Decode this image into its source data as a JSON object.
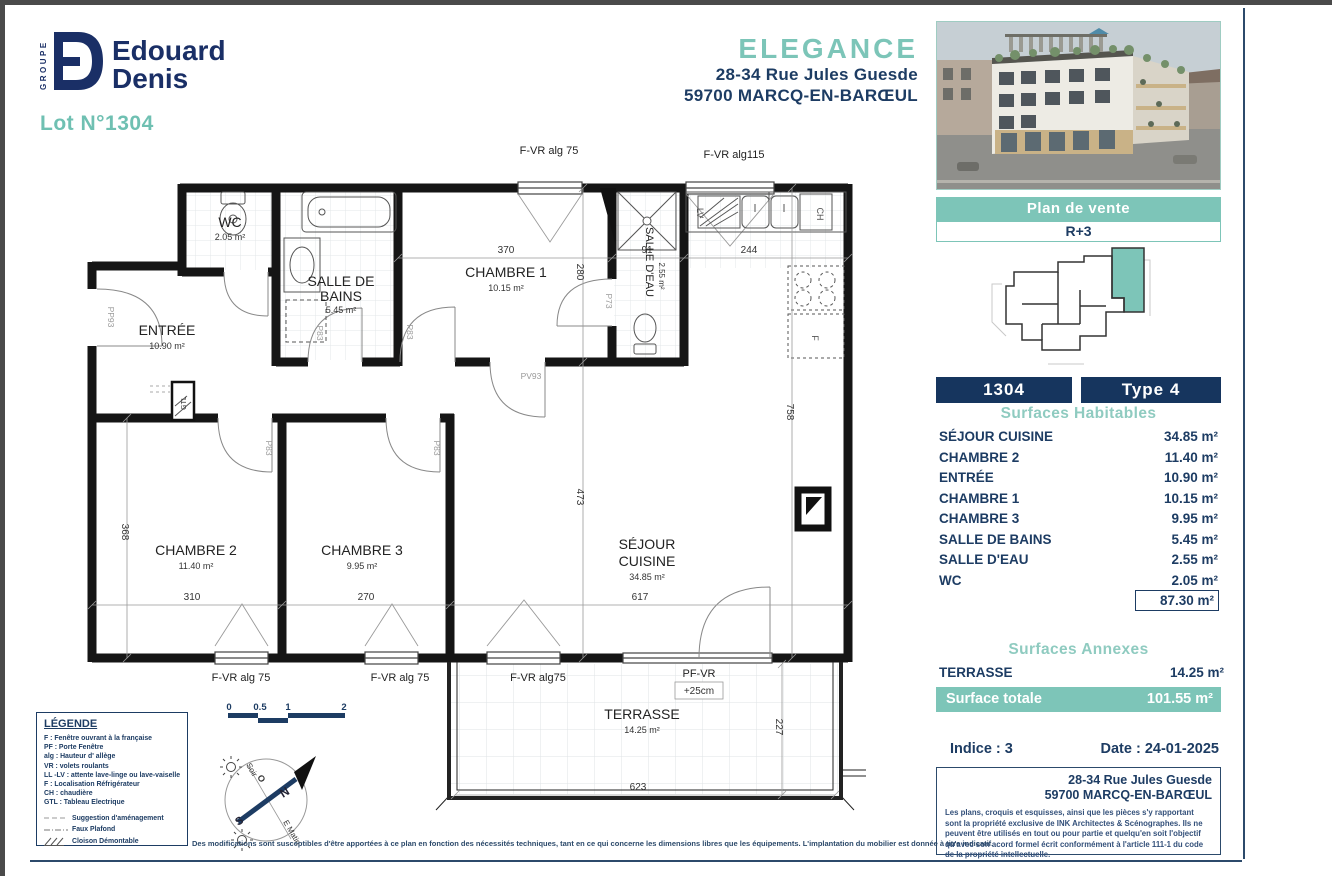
{
  "header": {
    "brand_group": "GROUPE",
    "brand_line1": "Edouard",
    "brand_line2": "Denis",
    "lot": "Lot N°1304",
    "project": "ELEGANCE",
    "address_line1": "28-34 Rue Jules Guesde",
    "address_line2": "59700 MARCQ-EN-BARŒUL"
  },
  "sidebar": {
    "plan_de_vente": "Plan de vente",
    "floor": "R+3",
    "lot_number": "1304",
    "type": "Type 4",
    "surfaces_habitables": {
      "title": "Surfaces Habitables",
      "rows": [
        {
          "label": "SÉJOUR CUISINE",
          "value": "34.85 m²"
        },
        {
          "label": "CHAMBRE 2",
          "value": "11.40 m²"
        },
        {
          "label": "ENTRÉE",
          "value": "10.90 m²"
        },
        {
          "label": "CHAMBRE 1",
          "value": "10.15 m²"
        },
        {
          "label": "CHAMBRE 3",
          "value": "9.95 m²"
        },
        {
          "label": "SALLE DE BAINS",
          "value": "5.45 m²"
        },
        {
          "label": "SALLE D'EAU",
          "value": "2.55 m²"
        },
        {
          "label": "WC",
          "value": "2.05 m²"
        }
      ],
      "total": "87.30 m²"
    },
    "surfaces_annexes": {
      "title": "Surfaces Annexes",
      "rows": [
        {
          "label": "TERRASSE",
          "value": "14.25 m²"
        }
      ]
    },
    "surface_totale": {
      "label": "Surface totale",
      "value": "101.55 m²"
    },
    "indice": "Indice : 3",
    "date": "Date : 24-01-2025",
    "footer_address1": "28-34 Rue Jules Guesde",
    "footer_address2": "59700 MARCQ-EN-BARŒUL",
    "copyright": "Les plans, croquis et esquisses, ainsi que les pièces s'y rapportant sont la propriété exclusive de INK Architectes & Scénographes. Ils ne peuvent être utilisés en tout ou pour partie et quelqu'en soit l'objectif qu'avec son acord formel écrit conformément à l'article 111-1 du code de la propriété intellectuelle."
  },
  "plan": {
    "rooms": [
      {
        "n1": "WC",
        "area": "2.05 m²"
      },
      {
        "n1": "SALLE DE",
        "n2": "BAINS",
        "area": "5.45 m²"
      },
      {
        "n1": "CHAMBRE 1",
        "area": "10.15 m²"
      },
      {
        "n1": "SALLE D'EAU",
        "area": "2.55 m²"
      },
      {
        "n1": "ENTRÉE",
        "area": "10.90 m²"
      },
      {
        "n1": "CHAMBRE 2",
        "area": "11.40 m²"
      },
      {
        "n1": "CHAMBRE 3",
        "area": "9.95 m²"
      },
      {
        "n1": "SÉJOUR",
        "n2": "CUISINE",
        "area": "34.85 m²"
      },
      {
        "n1": "TERRASSE",
        "area": "14.25 m²"
      }
    ],
    "window_labels": [
      "F-VR alg 75",
      "F-VR alg115",
      "F-VR alg 75",
      "F-VR alg 75",
      "F-VR alg75",
      "PF-VR",
      "+25cm"
    ],
    "door_labels": {
      "pp93": "PP93",
      "p83": "P83",
      "p73": "P73",
      "pv93": "PV93"
    },
    "fixtures": {
      "lv": "LV",
      "ch": "CH",
      "f": "F",
      "gtl": "GTL"
    },
    "dims": [
      "370",
      "91",
      "244",
      "280",
      "473",
      "758",
      "368",
      "310",
      "270",
      "617",
      "623",
      "227"
    ]
  },
  "scalebar": {
    "labels": [
      "0",
      "0.5",
      "1",
      "2"
    ]
  },
  "compass": {
    "n": "N",
    "s": "S",
    "o": "O",
    "soir": "Soir",
    "e_matin": "E Matin"
  },
  "legend": {
    "title": "LÉGENDE",
    "lines": [
      "F : Fenêtre ouvrant à la française",
      "PF : Porte Fenêtre",
      "alg :  Hauteur d' allège",
      "VR : volets roulants",
      "LL -LV : attente lave-linge ou lave-vaiselle",
      "F : Localisation Réfrigérateur",
      "CH : chaudière",
      "GTL : Tableau Electrique"
    ],
    "items": [
      "Suggestion d'aménagement",
      "Faux Plafond",
      "Cloison Démontable"
    ]
  },
  "disclaimer": "Des modifications sont susceptibles d'être apportées à ce plan en fonction des nécessités techniques, tant en ce qui concerne les dimensions libres que les équipements. L'implantation du mobilier est donnée à titre indicatif."
}
